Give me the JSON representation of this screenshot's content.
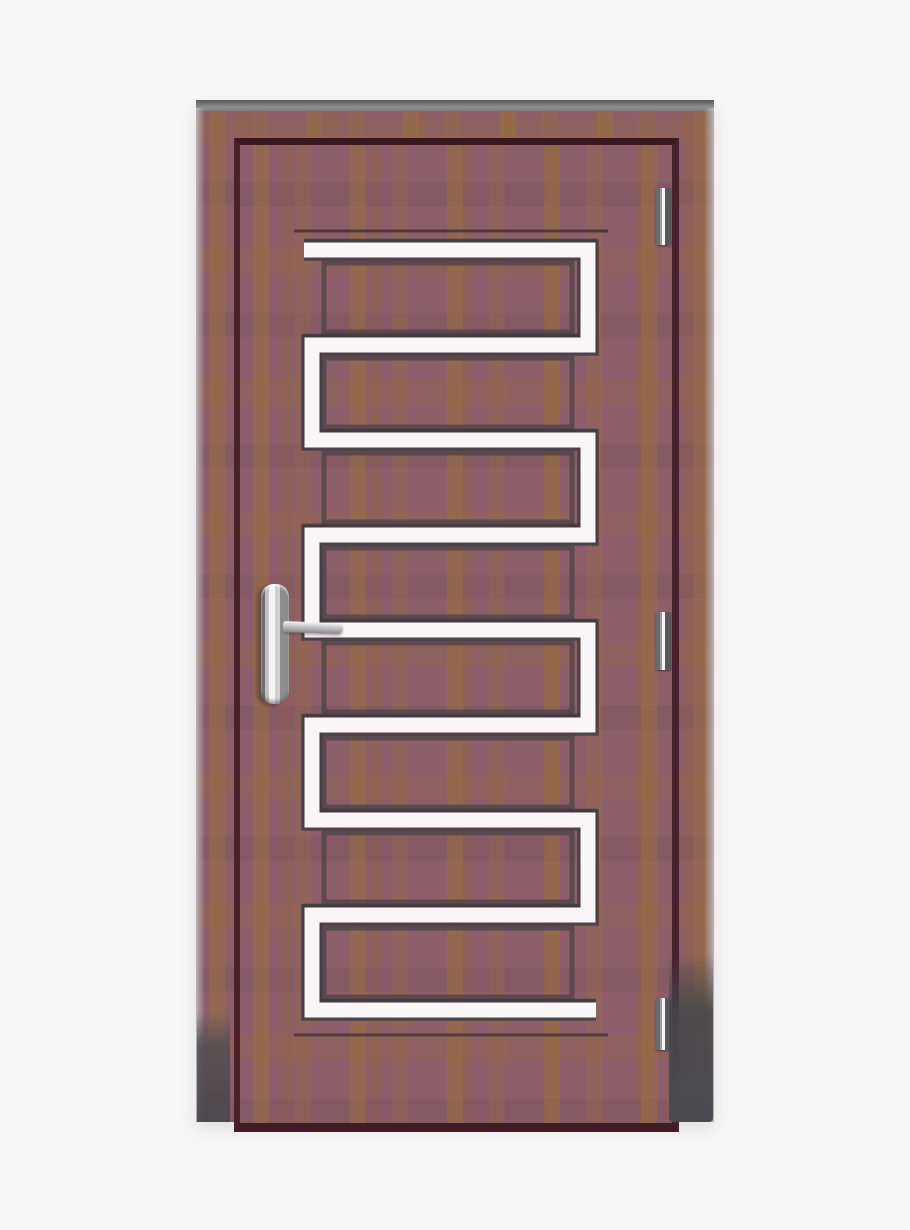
{
  "scene": {
    "description": "Product photo of a modern single wooden door in a mauve-brown woodgrain finish with a continuous white serpentine zig-zag inlay, a chrome lever handle on the left stile, three hinges on the right stile, set in a matching wooden frame on a plain off-white background.",
    "background_color": "#f8f7f7"
  },
  "door_frame": {
    "label": "wooden door frame",
    "wood_color": "#8c5e69",
    "wood_streak_color": "#996e3e",
    "top_edge_color": "#8f8f90"
  },
  "door_leaf": {
    "label": "door leaf",
    "wood_color": "#8c5e69",
    "gap_shadow_color": "#4a202b"
  },
  "inlay": {
    "label": "white serpentine inlay stripe",
    "color": "#faf5f7",
    "shadow_color": "#4a4148",
    "bar_count": 9,
    "pattern": "horizontal bars joined by alternating right and left vertical connectors"
  },
  "panel_grooves": {
    "label": "recessed wood panel grooves",
    "count": 8,
    "color": "#4f444b"
  },
  "handle": {
    "label": "chrome lever door handle",
    "side": "left",
    "plate_color": "#d9d9db",
    "lever_color": "#c7c7c9"
  },
  "hinges": {
    "label": "door hinge",
    "count": 3,
    "plate_color": "#6b6b6d",
    "pin_highlight_color": "#f5f5f5"
  }
}
